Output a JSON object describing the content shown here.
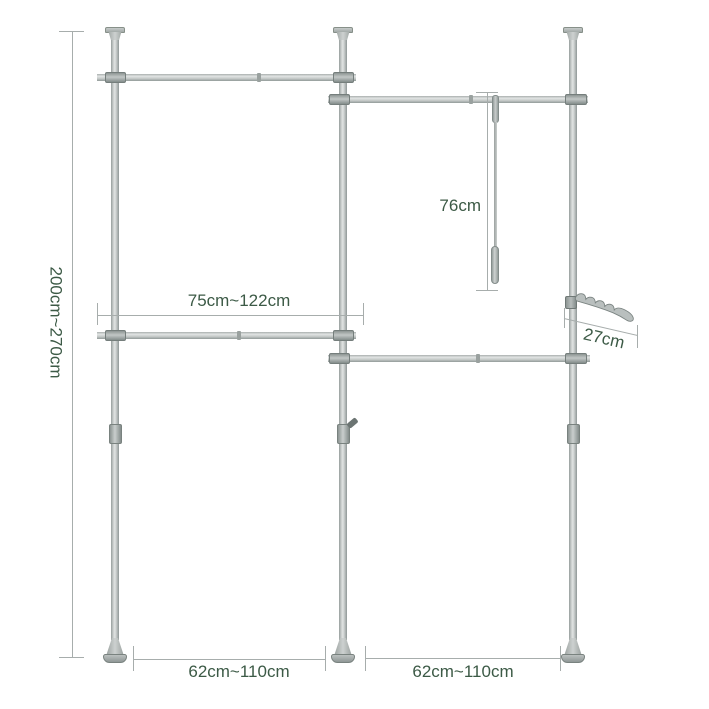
{
  "canvas": {
    "width": 709,
    "height": 709,
    "background": "#ffffff"
  },
  "palette": {
    "metal_light": "#e1e4e3",
    "metal_mid": "#c6cbca",
    "metal_dark": "#8f9796",
    "connector_gray": "#a7aeac",
    "dimension_line": "#a7adac",
    "label_text": "#3c5a46"
  },
  "dimensions": {
    "height_range": "200cm~270cm",
    "upper_bar_range": "75cm~122cm",
    "swing_rod_length": "76cm",
    "hook_length": "27cm",
    "bottom_left_span": "62cm~110cm",
    "bottom_right_span": "62cm~110cm"
  }
}
